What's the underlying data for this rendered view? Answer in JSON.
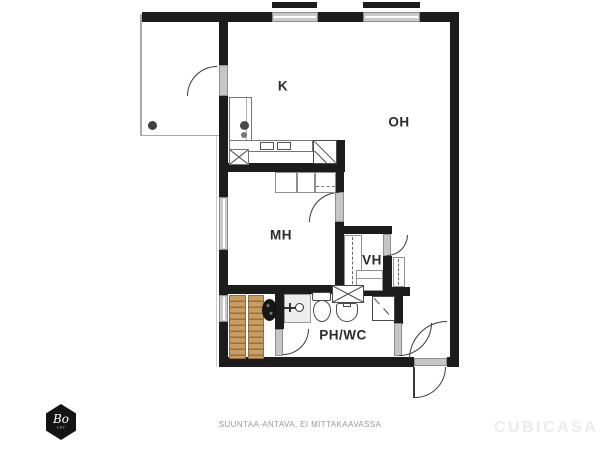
{
  "plan": {
    "rooms": [
      {
        "id": "kitchen",
        "label": "K"
      },
      {
        "id": "living-room",
        "label": "OH"
      },
      {
        "id": "bedroom",
        "label": "MH"
      },
      {
        "id": "hallway",
        "label": "VH"
      },
      {
        "id": "bathroom",
        "label": "PH/WC"
      }
    ],
    "fixture_icons": [
      "sauna-bench",
      "sauna-stove",
      "shower-faucet",
      "toilet",
      "washing-machine",
      "bathroom-sink",
      "shower-stall",
      "kitchen-counter",
      "kitchen-sink-faucet",
      "stove",
      "dishwasher",
      "hob-burners",
      "wardrobe",
      "closet",
      "floor-drain"
    ],
    "colors": {
      "wall": "#1c1c1c",
      "window_fill": "#c9c9c9",
      "door_fill": "#c6c6c6",
      "sauna_wood": "#c89d63",
      "sauna_wood_line": "#97713d",
      "label_text": "#2b2b2b",
      "disclaimer_text": "#9a9a9a",
      "watermark_text": "#ececec",
      "logo_background": "#141414"
    }
  },
  "footer": {
    "disclaimer": "SUUNTAA-ANTAVA, EI MITTAKAAVASSA",
    "brand": "CUBICASA",
    "agency": {
      "name": "Bo",
      "subtitle": "LKV"
    }
  }
}
